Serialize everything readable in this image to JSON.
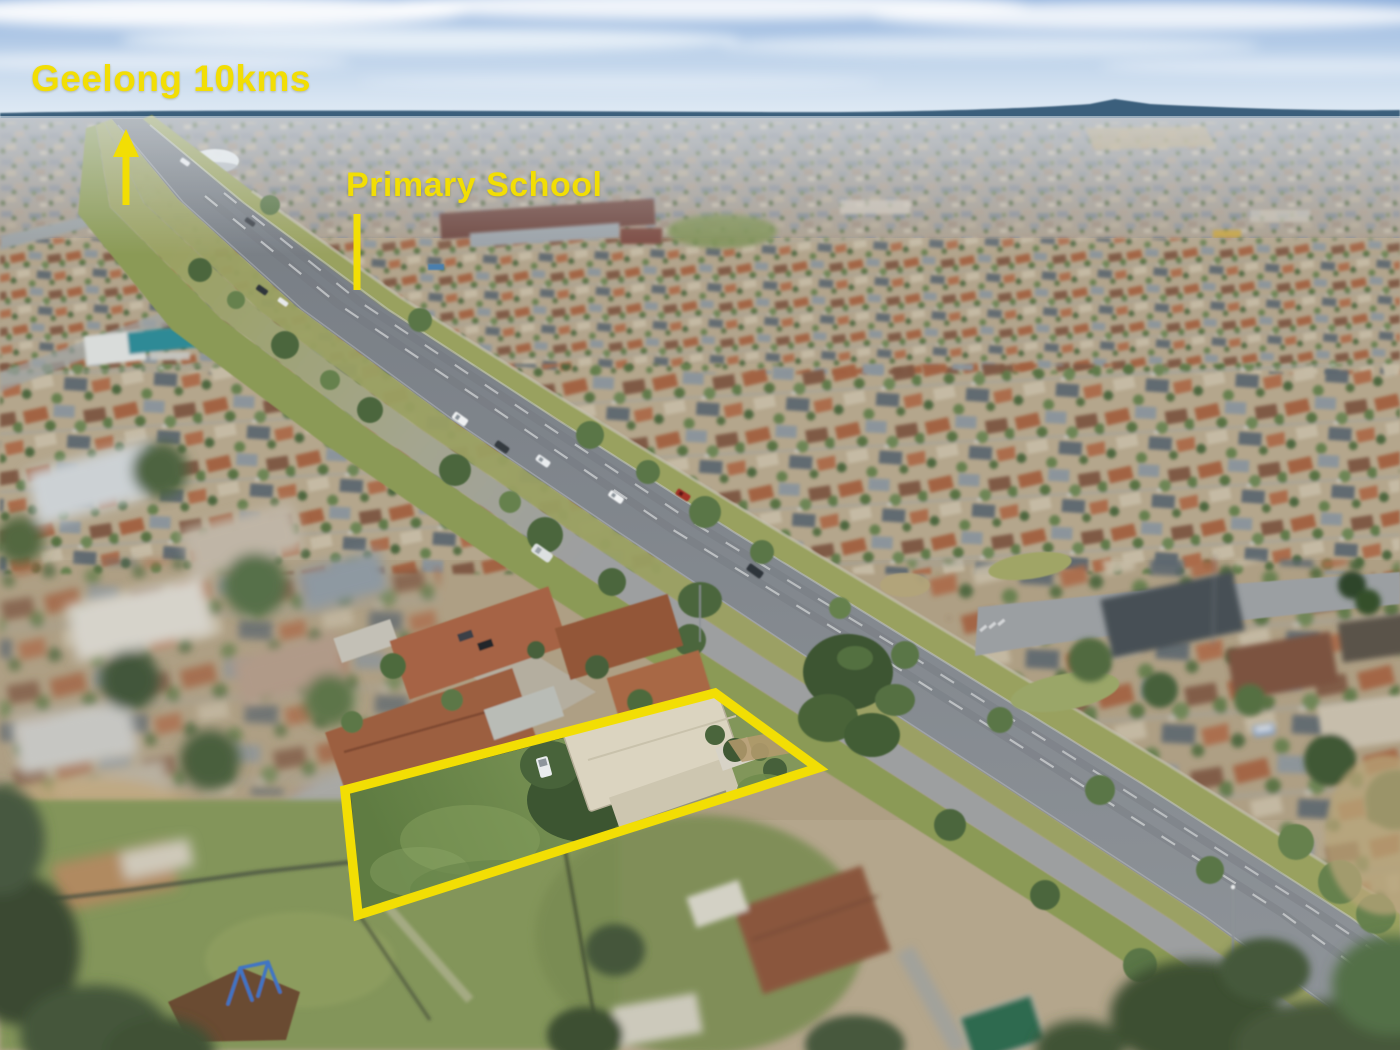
{
  "annotations": {
    "geelong": {
      "text": "Geelong 10kms"
    },
    "school": {
      "text": "Primary School"
    }
  },
  "palette": {
    "annotation_yellow": "#F2DE04",
    "sky_top": "#8FB0DC",
    "sky_horizon": "#E8F0F7",
    "distant_hills": "#3A5E7C",
    "road_grey": "#83898F",
    "verge_olive": "#9AA164",
    "grass_green": "#74904F",
    "roof_terracotta": "#9C5E3F",
    "property_roof_cream": "#DBD4C0",
    "tree_green": "#4E6A3D",
    "playground_blue": "#3F74C4"
  }
}
